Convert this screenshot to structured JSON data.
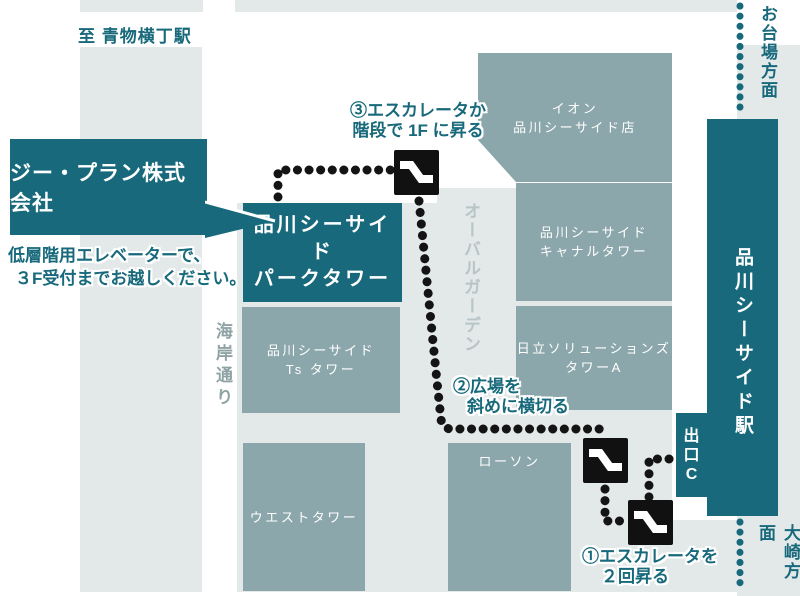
{
  "colors": {
    "accent_teal": "#17697b",
    "building_gray_teal": "#8ba7ab",
    "city_block_gray": "#e3e8e8",
    "route_dot_black": "#141414",
    "street_white": "#ffffff",
    "oval_garden_text": "#b7c5c7",
    "kaigan_street_text": "#8fa3a6"
  },
  "directions": {
    "to_aomono_station": "至 青物横丁駅",
    "to_odaiba": "お台場方面",
    "to_osaki": "大崎方面"
  },
  "streets": {
    "kaigan_dori": "海岸通り",
    "oval_garden": "オーバルガーデン"
  },
  "callout": {
    "company": "ジー・プラン株式会社",
    "note_line1": "低層階用エレベーターで、",
    "note_line2": "３F受付までお越しください。"
  },
  "buildings": {
    "aeon_line1": "イオン",
    "aeon_line2": "品川シーサイド店",
    "canal_line1": "品川シーサイド",
    "canal_line2": "キャナルタワー",
    "hitachi_line1": "日立ソリューションズ",
    "hitachi_line2": "タワーA",
    "lawson": "ローソン",
    "west_tower": "ウエストタワー",
    "ts_line1": "品川シーサイド",
    "ts_line2": "Ts タワー",
    "park_line1": "品川シーサイド",
    "park_line2": "パークタワー",
    "station": "品川シーサイド駅",
    "exit_c": "出口C"
  },
  "steps": {
    "step1_line1": "①エスカレータを",
    "step1_line2": "２回昇る",
    "step2_line1": "②広場を",
    "step2_line2": "斜めに横切る",
    "step3_line1": "③エスカレータか",
    "step3_line2": "階段で 1F に昇る"
  },
  "icons": {
    "escalator": "escalator-icon"
  }
}
